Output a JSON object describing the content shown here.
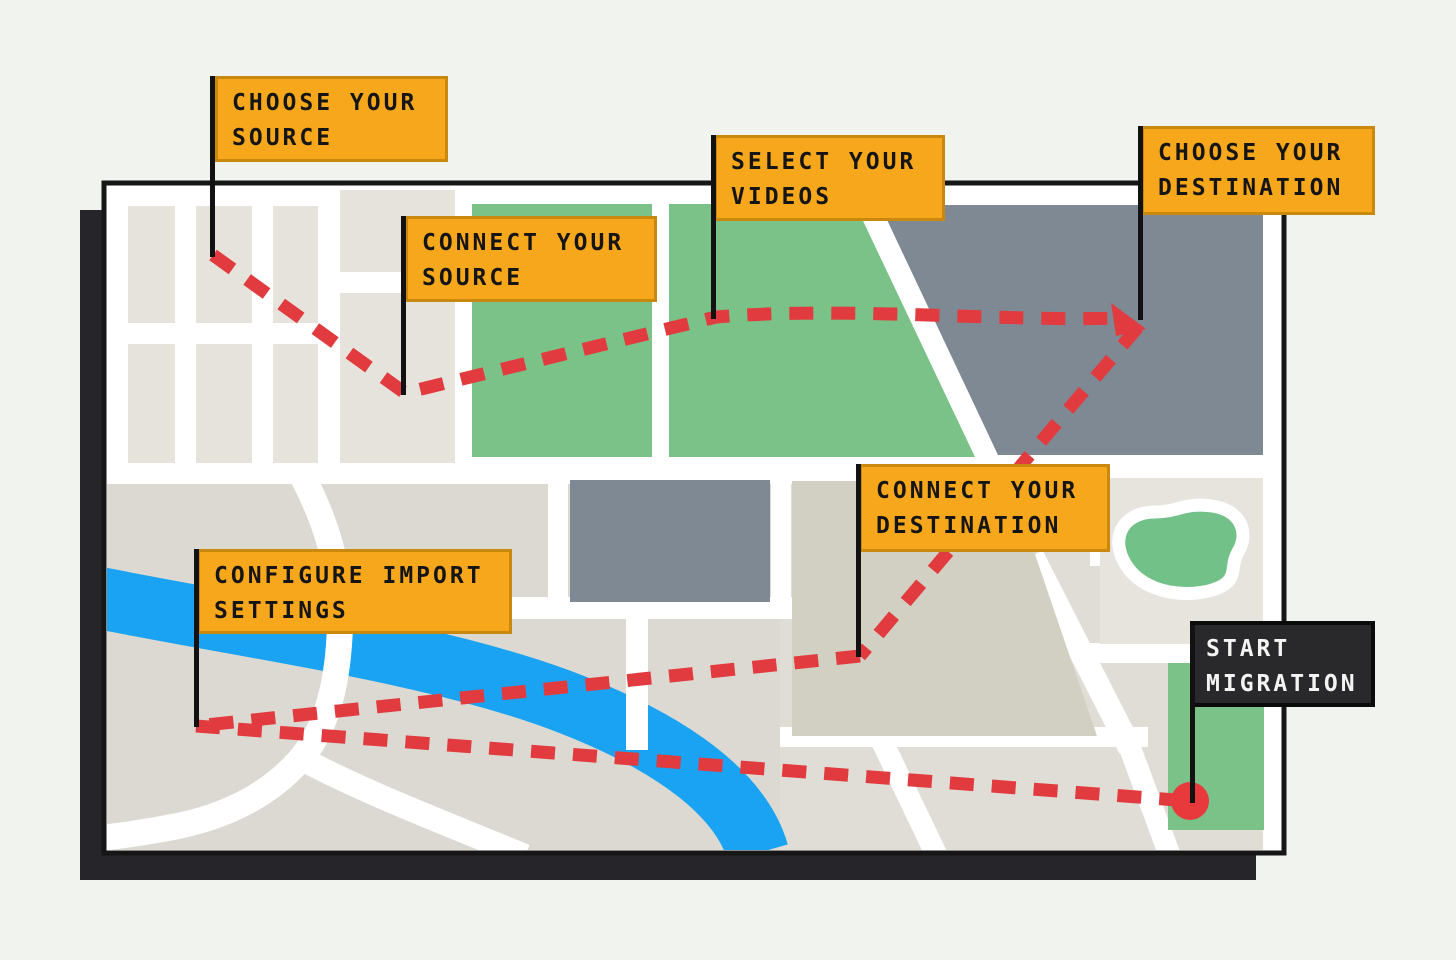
{
  "illustration": {
    "title": "video migration journey map",
    "steps": [
      {
        "label": "CHOOSE YOUR SOURCE",
        "variant": "orange"
      },
      {
        "label": "CONNECT YOUR SOURCE",
        "variant": "orange"
      },
      {
        "label": "SELECT YOUR VIDEOS",
        "variant": "orange"
      },
      {
        "label": "CHOOSE YOUR DESTINATION",
        "variant": "orange"
      },
      {
        "label": "CONNECT YOUR DESTINATION",
        "variant": "orange"
      },
      {
        "label": "CONFIGURE IMPORT SETTINGS",
        "variant": "orange"
      },
      {
        "label": "START MIGRATION",
        "variant": "dark"
      }
    ],
    "route": {
      "style": "red-dashed-line",
      "end_marker": "red-dot",
      "direction_marker": "red-arrowhead"
    },
    "colors": {
      "page_background": "#f1f3ee",
      "flag_orange": "#f6a71b",
      "flag_orange_border": "#c9880e",
      "flag_dark": "#29292c",
      "flag_dark_text": "#f4f4f2",
      "flag_text": "#151515",
      "route_red": "#e23b3f",
      "park_green": "#7ac288",
      "water_blue": "#1aa3f2",
      "block_slate": "#7e8994",
      "block_beige": "#dbd9d1",
      "street_white": "#ffffff",
      "map_border": "#161616",
      "shadow": "#25252a"
    }
  }
}
